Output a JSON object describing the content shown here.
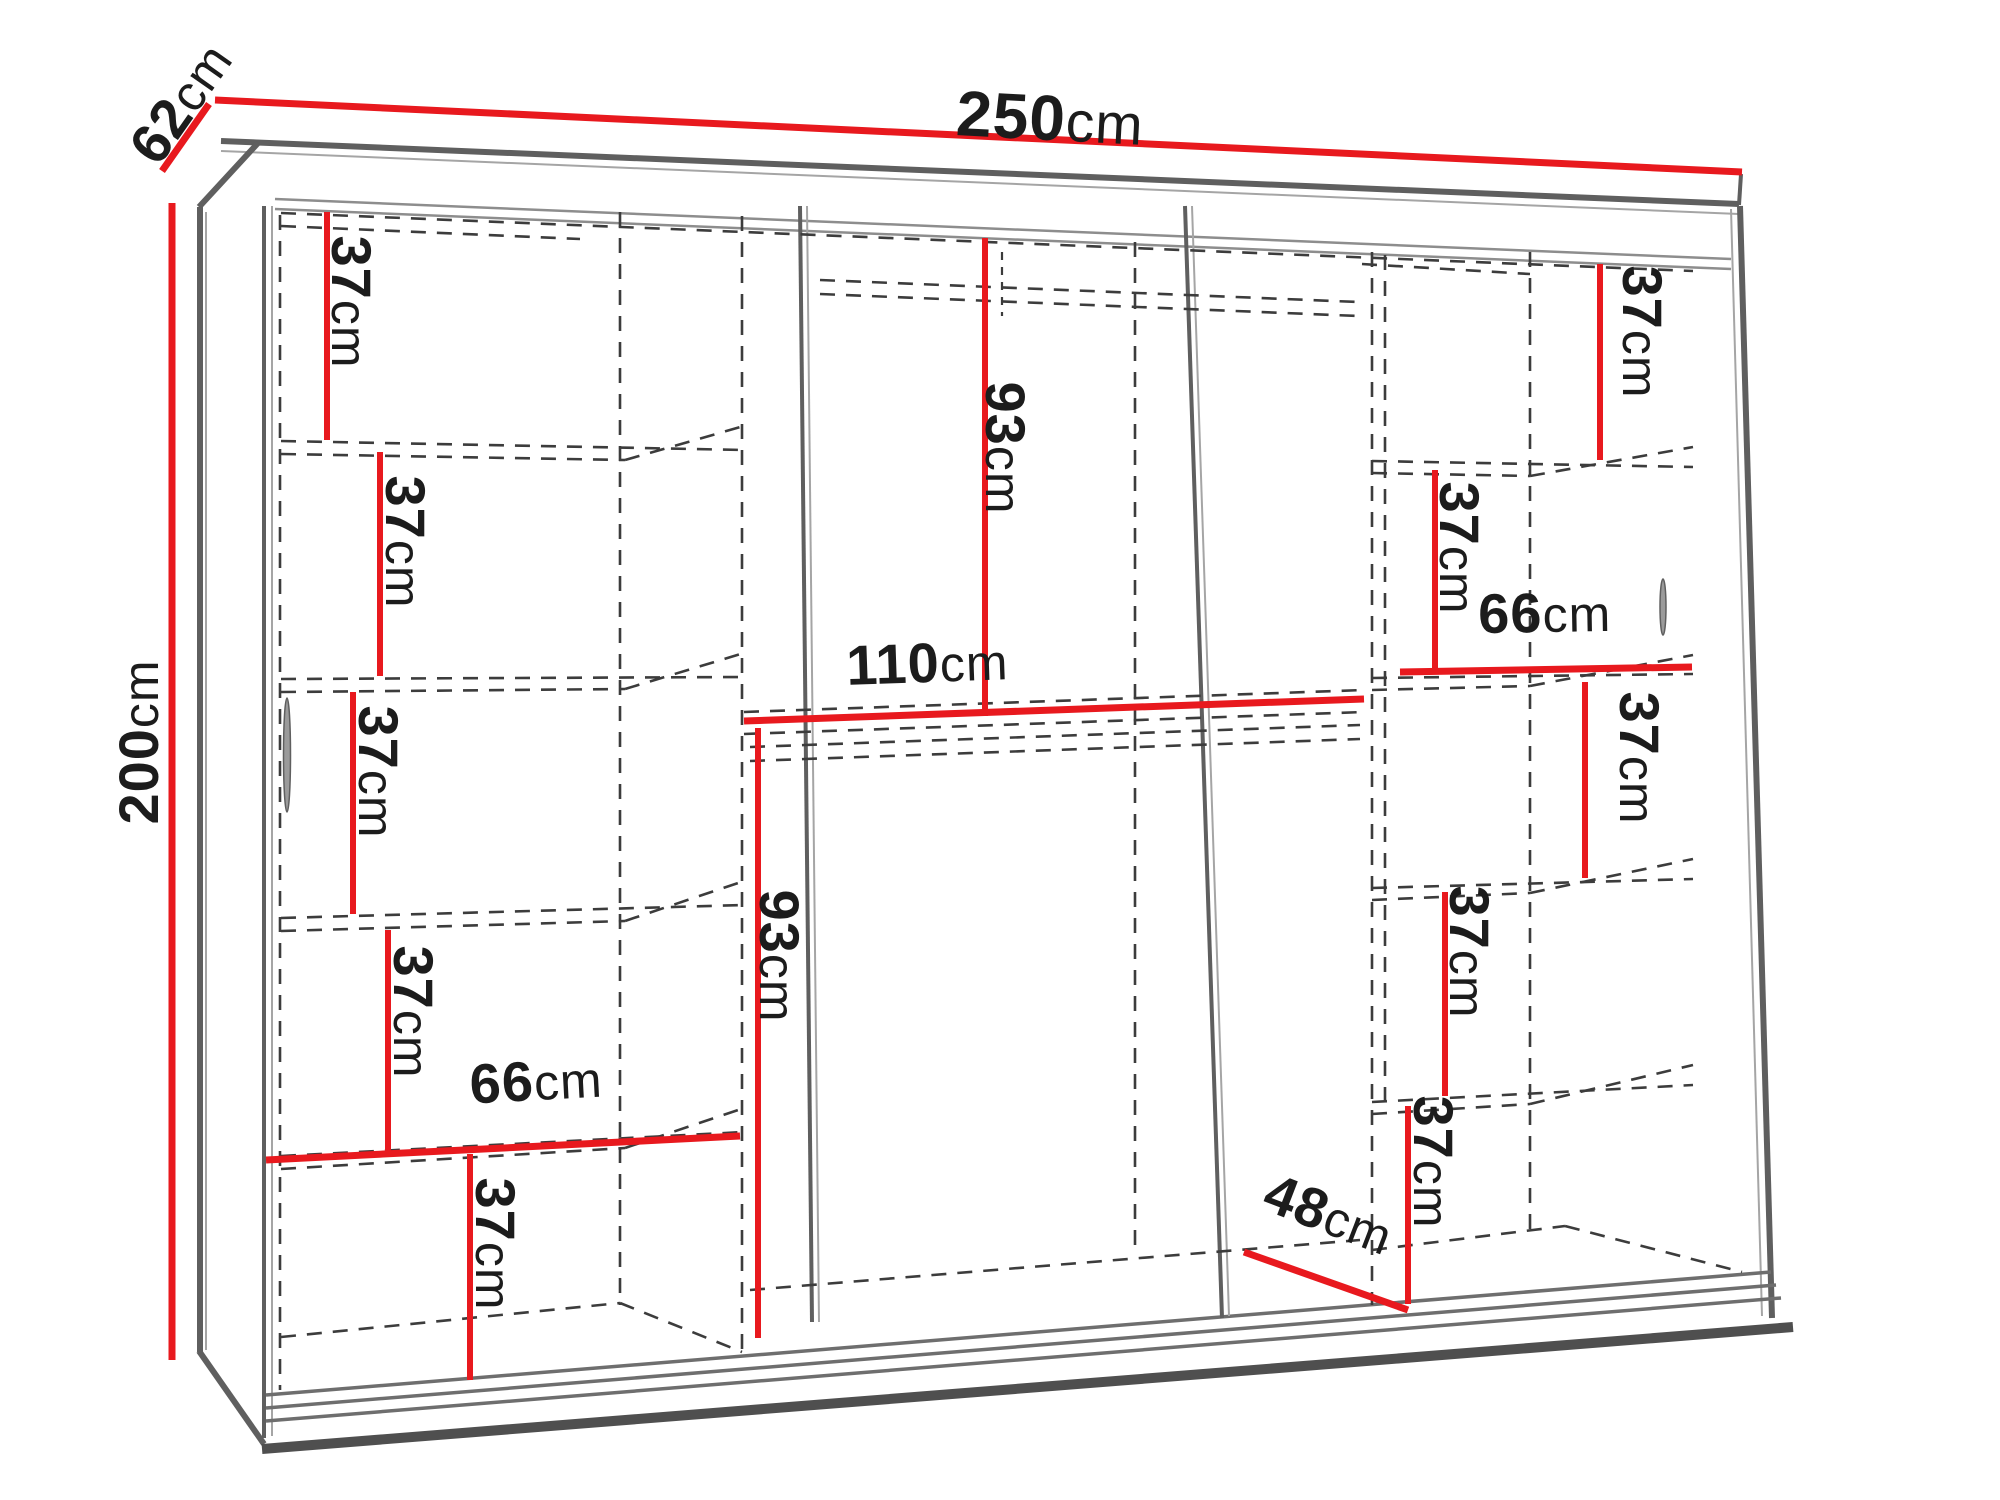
{
  "diagram_title": "Wardrobe interior dimension diagram",
  "colors": {
    "dimension_line": "#e8191e",
    "frame": "#5f5f5f",
    "dashed_line": "#3c3c3c",
    "text": "#1c1c1c",
    "background": "#ffffff"
  },
  "dimensions": {
    "width": {
      "value": "250",
      "unit": "cm"
    },
    "depth": {
      "value": "62",
      "unit": "cm"
    },
    "height": {
      "value": "200",
      "unit": "cm"
    },
    "left_column": {
      "shelf_gaps": [
        {
          "value": "37",
          "unit": "cm"
        },
        {
          "value": "37",
          "unit": "cm"
        },
        {
          "value": "37",
          "unit": "cm"
        },
        {
          "value": "37",
          "unit": "cm"
        },
        {
          "value": "37",
          "unit": "cm"
        }
      ],
      "column_width": {
        "value": "66",
        "unit": "cm"
      }
    },
    "middle_section": {
      "upper_hanging_height": {
        "value": "93",
        "unit": "cm"
      },
      "section_width": {
        "value": "110",
        "unit": "cm"
      },
      "lower_hanging_height": {
        "value": "93",
        "unit": "cm"
      },
      "floor_depth": {
        "value": "48",
        "unit": "cm"
      }
    },
    "right_column": {
      "shelf_gaps": [
        {
          "value": "37",
          "unit": "cm"
        },
        {
          "value": "37",
          "unit": "cm"
        },
        {
          "value": "37",
          "unit": "cm"
        },
        {
          "value": "37",
          "unit": "cm"
        },
        {
          "value": "37",
          "unit": "cm"
        }
      ],
      "column_width": {
        "value": "66",
        "unit": "cm"
      }
    }
  }
}
